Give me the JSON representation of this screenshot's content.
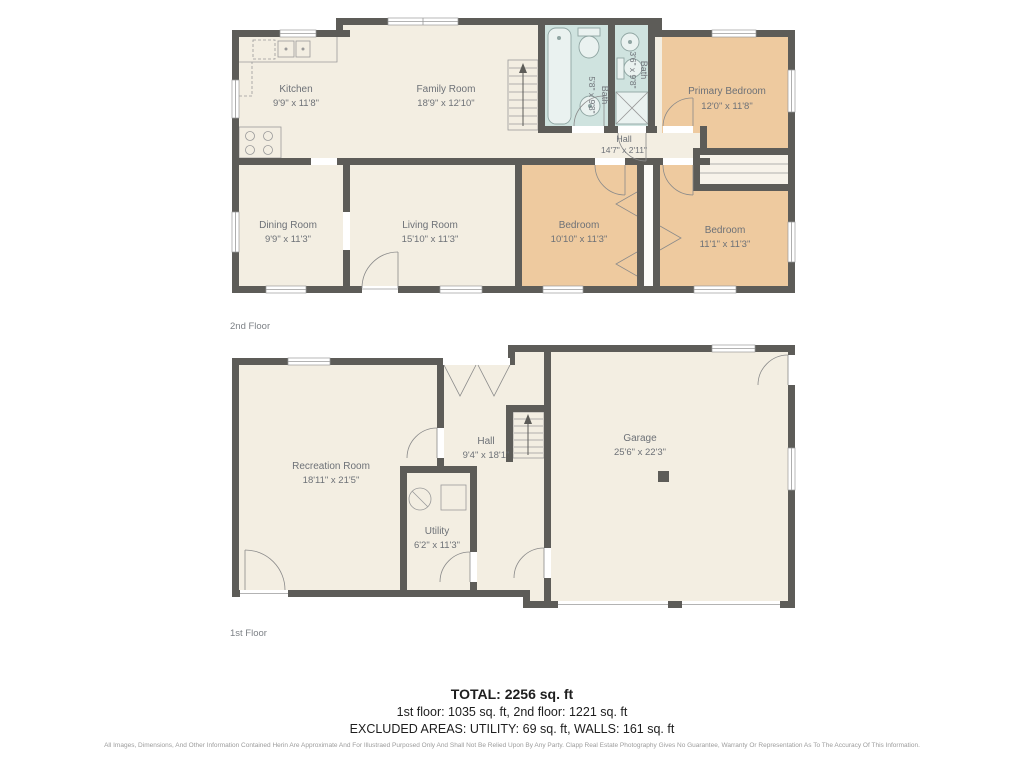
{
  "floors": {
    "second": {
      "label": "2nd Floor",
      "rooms": [
        {
          "id": "kitchen",
          "name": "Kitchen",
          "dims": "9'9\" x 11'8\""
        },
        {
          "id": "family-room",
          "name": "Family Room",
          "dims": "18'9\" x 12'10\""
        },
        {
          "id": "bath-main",
          "name": "Bath",
          "dims": "5'8\" x 9'8\""
        },
        {
          "id": "bath-small",
          "name": "Bath",
          "dims": "3'6\" x 9'8\""
        },
        {
          "id": "hall",
          "name": "Hall",
          "dims": "14'7\" x 2'11\""
        },
        {
          "id": "primary-bedroom",
          "name": "Primary Bedroom",
          "dims": "12'0\" x 11'8\""
        },
        {
          "id": "dining-room",
          "name": "Dining Room",
          "dims": "9'9\" x 11'3\""
        },
        {
          "id": "living-room",
          "name": "Living Room",
          "dims": "15'10\" x 11'3\""
        },
        {
          "id": "bedroom-a",
          "name": "Bedroom",
          "dims": "10'10\" x 11'3\""
        },
        {
          "id": "bedroom-b",
          "name": "Bedroom",
          "dims": "11'1\" x 11'3\""
        }
      ]
    },
    "first": {
      "label": "1st Floor",
      "rooms": [
        {
          "id": "recreation-room",
          "name": "Recreation Room",
          "dims": "18'11\" x 21'5\""
        },
        {
          "id": "hall",
          "name": "Hall",
          "dims": "9'4\" x 18'1\""
        },
        {
          "id": "garage",
          "name": "Garage",
          "dims": "25'6\" x 22'3\""
        },
        {
          "id": "utility",
          "name": "Utility",
          "dims": "6'2\" x 11'3\""
        }
      ]
    }
  },
  "summary": {
    "total": "TOTAL: 2256 sq. ft",
    "floors_line": "1st floor: 1035 sq. ft, 2nd floor: 1221 sq. ft",
    "excluded_line": "EXCLUDED AREAS: UTILITY: 69 sq. ft, WALLS: 161 sq. ft"
  },
  "disclaimer": "All Images, Dimensions, And Other Information Contained Herin Are Approximate And For Illustraed Purposed Only And Shall Not Be Relied Upon By Any Party. Clapp Real Estate Photography Gives No Guarantee, Warranty Or Representation As To The Accuracy Of This Information.",
  "colors": {
    "wall": "#5d5c58",
    "floor": "#f3eee2",
    "bedroom": "#eeca9f",
    "bath": "#cfe3df",
    "label_text": "#6d7177",
    "summary_text": "#1e1e1e",
    "disclaimer_text": "#9c9c9c"
  }
}
